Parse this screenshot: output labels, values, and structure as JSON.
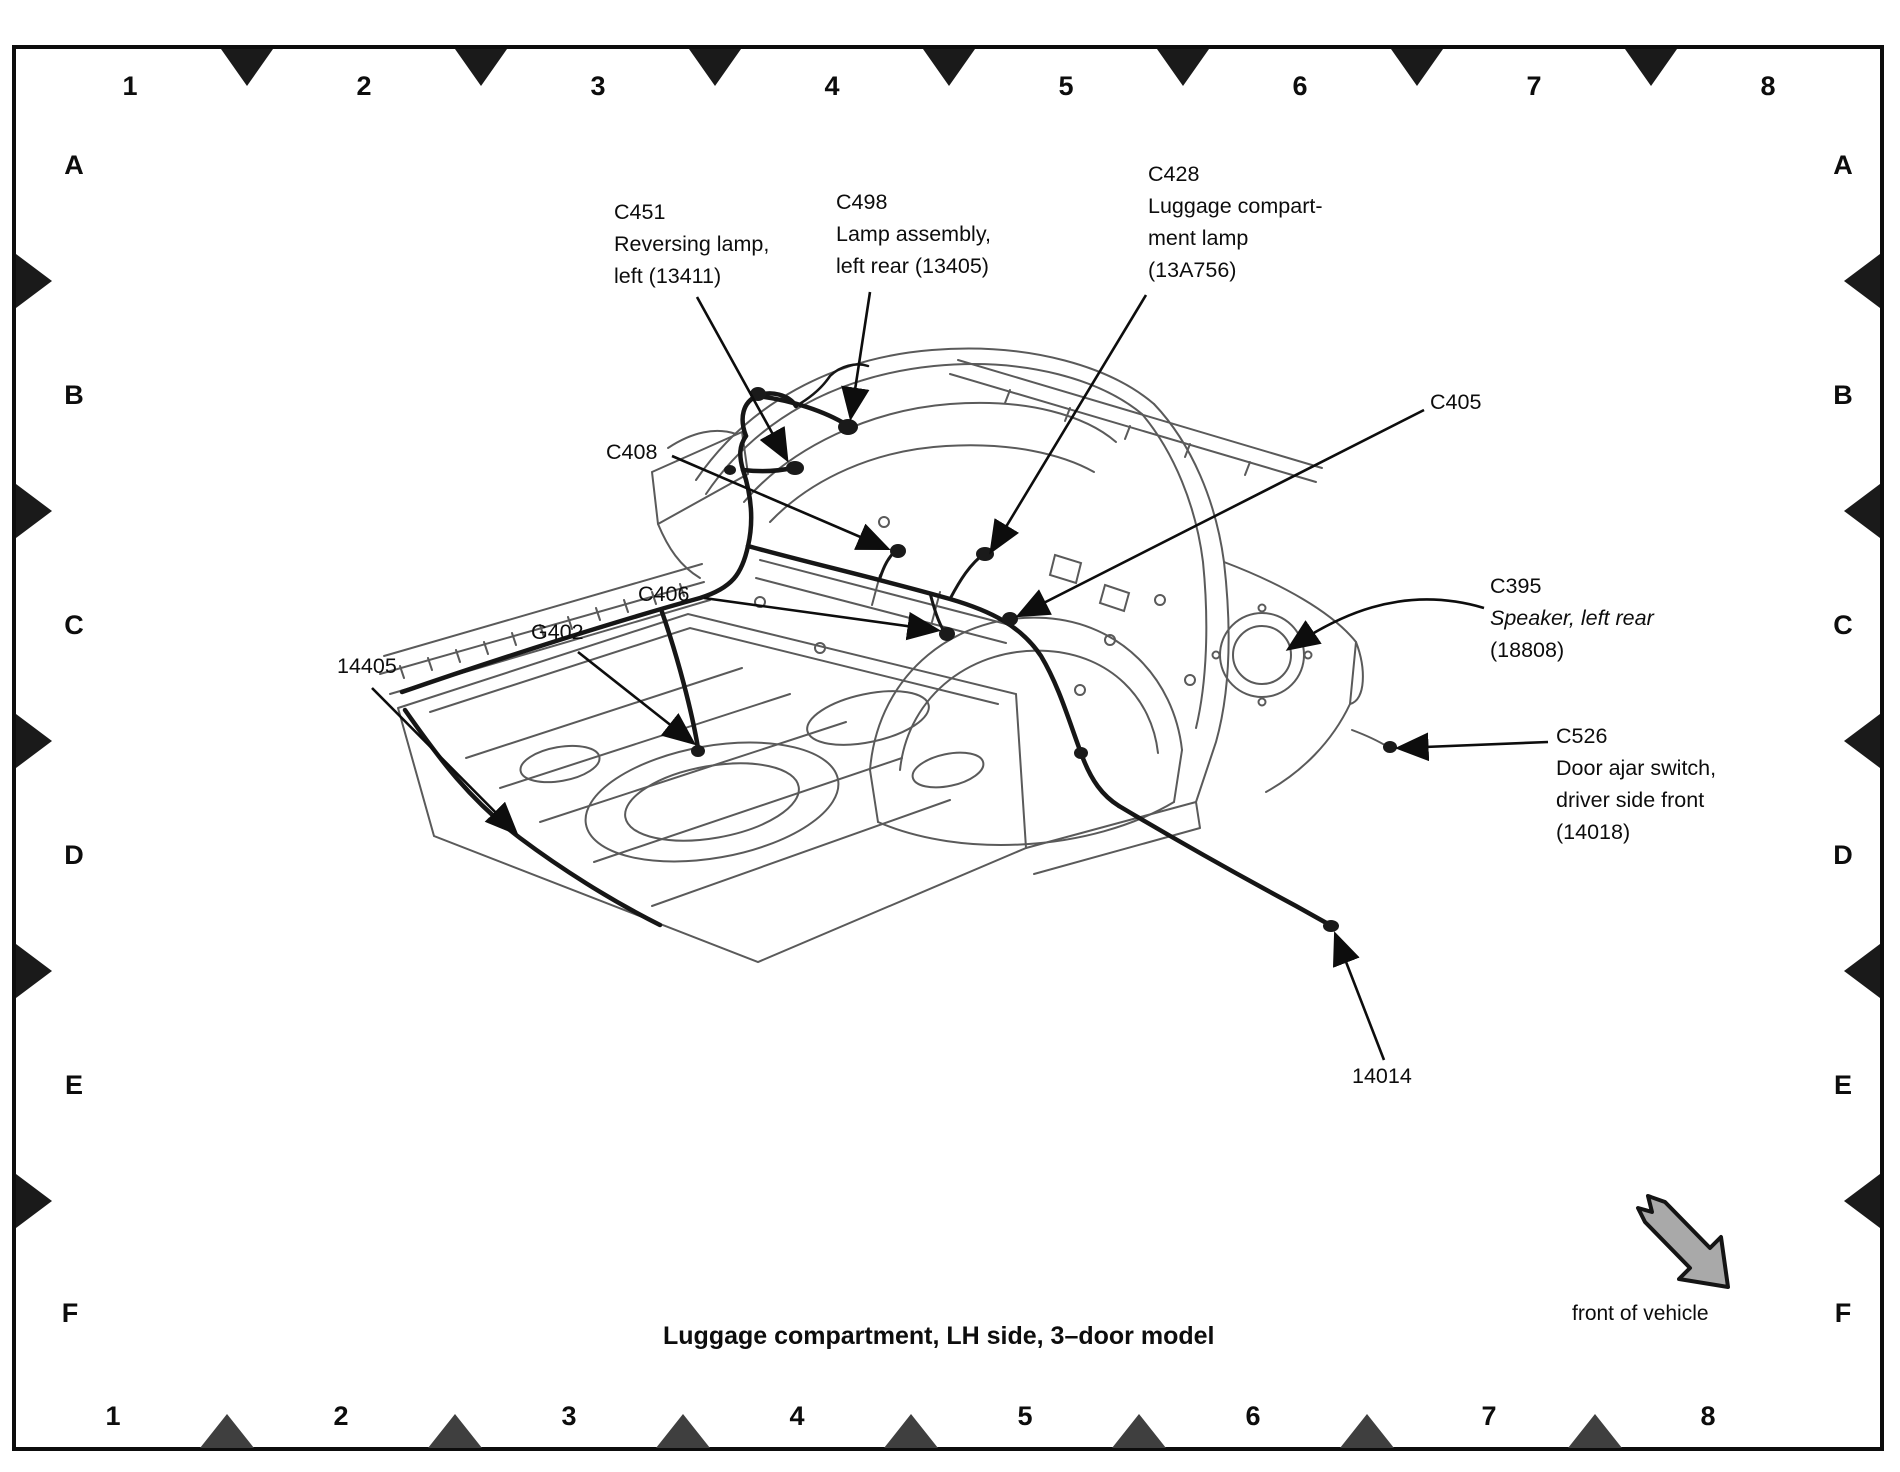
{
  "page": {
    "caption": "Luggage compartment, LH side, 3–door model",
    "front_of_vehicle": "front of vehicle"
  },
  "grid": {
    "columns": [
      "1",
      "2",
      "3",
      "4",
      "5",
      "6",
      "7",
      "8"
    ],
    "rows": [
      "A",
      "B",
      "C",
      "D",
      "E",
      "F"
    ]
  },
  "callouts": {
    "c451": {
      "code": "C451",
      "line1": "Reversing lamp,",
      "line2": "left (13411)"
    },
    "c498": {
      "code": "C498",
      "line1": "Lamp assembly,",
      "line2": "left rear (13405)"
    },
    "c428": {
      "code": "C428",
      "line1": "Luggage compart-",
      "line2": "ment lamp",
      "line3": "(13A756)"
    },
    "c405": {
      "code": "C405"
    },
    "c408": {
      "code": "C408"
    },
    "c406": {
      "code": "C406"
    },
    "g402": {
      "code": "G402"
    },
    "h14405": {
      "code": "14405"
    },
    "c395": {
      "code": "C395",
      "line1": "Speaker, left rear",
      "line2": "(18808)"
    },
    "c526": {
      "code": "C526",
      "line1": "Door ajar switch,",
      "line2": "driver side front",
      "line3": "(14018)"
    },
    "h14014": {
      "code": "14014"
    }
  },
  "colors": {
    "ink": "#0d0d0d",
    "line_art": "#5a5a5a",
    "marker_gray": "#3f3f3f",
    "front_arrow_fill": "#a9a9a9",
    "background": "#ffffff"
  }
}
